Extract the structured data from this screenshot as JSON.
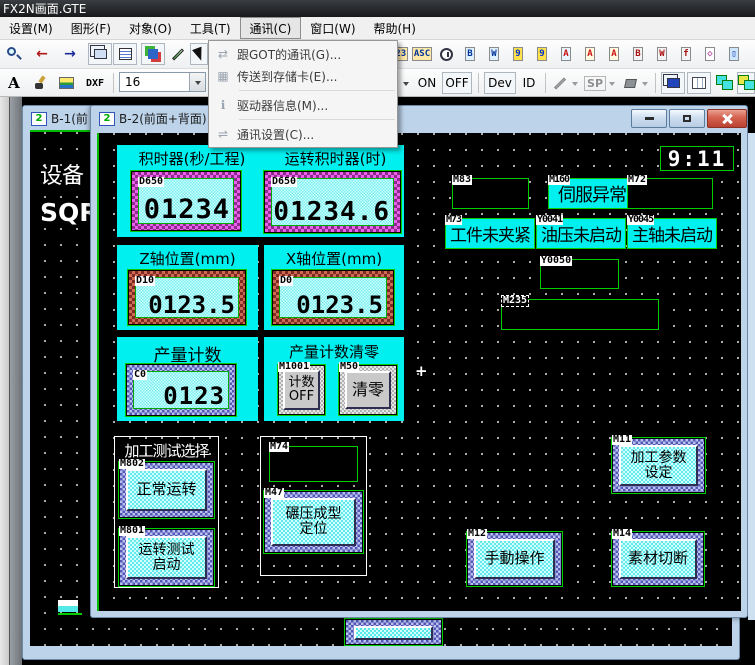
{
  "titlebar": {
    "title": "FX2N画面.GTE"
  },
  "menubar": {
    "items": [
      {
        "label": "设置(M)"
      },
      {
        "label": "图形(F)"
      },
      {
        "label": "对象(O)"
      },
      {
        "label": "工具(T)"
      },
      {
        "label": "通讯(C)"
      },
      {
        "label": "窗口(W)"
      },
      {
        "label": "帮助(H)"
      }
    ]
  },
  "comm_menu": {
    "items": [
      {
        "glyph": "⇄",
        "label": "跟GOT的通讯(G)..."
      },
      {
        "glyph": "▦",
        "label": "传送到存储卡(E)..."
      },
      {
        "glyph": "ℹ",
        "label": "驱动器信息(M)..."
      },
      {
        "glyph": "⇌",
        "label": "通讯设置(C)..."
      }
    ]
  },
  "toolbar1": {
    "objects": [
      {
        "glyph": "123"
      },
      {
        "glyph": "ASC"
      },
      {
        "glyph": "◷"
      },
      {
        "glyph": "B"
      },
      {
        "glyph": "W"
      },
      {
        "glyph": "9"
      },
      {
        "glyph": "9"
      },
      {
        "glyph": "A"
      },
      {
        "glyph": "A"
      },
      {
        "glyph": "A"
      },
      {
        "glyph": "B"
      },
      {
        "glyph": "W"
      },
      {
        "glyph": "f"
      },
      {
        "glyph": "◇"
      },
      {
        "glyph": "▯"
      }
    ]
  },
  "toolbar2": {
    "text_tool": "A",
    "dxf": "DXF",
    "font_size": "16",
    "on": "ON",
    "off": "OFF",
    "dev": "Dev",
    "id": "ID",
    "sp": "SP"
  },
  "windows": {
    "b1_title": "B-1(前",
    "b2_title": "B-2(前面+背面):3",
    "gtd_icon": "2"
  },
  "b1_canvas": {
    "line1": "设备",
    "line2": "SQR"
  },
  "canvas": {
    "clock": "9:11",
    "timer_panel": {
      "header_left": "积时器(秒/工程)",
      "header_right": "运转积时器(时)",
      "display1": {
        "tag": "D650",
        "value": "01234"
      },
      "display2": {
        "tag": "D650",
        "value": "01234.6"
      }
    },
    "z_panel": {
      "header": "Z轴位置(mm)",
      "display": {
        "tag": "D10",
        "value": "0123.5"
      }
    },
    "x_panel": {
      "header": "X轴位置(mm)",
      "display": {
        "tag": "D0",
        "value": "0123.5"
      }
    },
    "count_panel": {
      "header": "产量计数",
      "display": {
        "tag": "C0",
        "value": "0123"
      }
    },
    "clear_panel": {
      "header": "产量计数清零",
      "count_off_btn": {
        "tag": "M1001",
        "line1": "计数",
        "line2": "OFF"
      },
      "clear_btn": {
        "tag": "M50",
        "label": "清零"
      }
    },
    "alarms": {
      "m83": {
        "tag": "M83"
      },
      "m160": {
        "tag": "M160",
        "text": "伺服异常"
      },
      "m72": {
        "tag": "M72"
      },
      "m73": {
        "tag": "M73",
        "text": "工件未夹紧"
      },
      "y0041": {
        "tag": "Y0041",
        "text": "油压未启动"
      },
      "y0045": {
        "tag": "Y0045",
        "text": "主轴未启动"
      },
      "y0050": {
        "tag": "Y0050"
      },
      "m235": {
        "tag": "M235"
      }
    },
    "test_group": {
      "title": "加工测试选择",
      "normal_btn": {
        "tag": "M802",
        "label": "正常运转"
      },
      "test_btn": {
        "tag": "M801",
        "line1": "运转测试",
        "line2": "启动"
      }
    },
    "m74_group": {
      "tag": "M74",
      "forming_btn": {
        "tag": "M47",
        "line1": "碾压成型",
        "line2": "定位"
      }
    },
    "param_btn": {
      "tag": "M11",
      "line1": "加工参数",
      "line2": "设定"
    },
    "manual_btn": {
      "tag": "M12",
      "label": "手動操作"
    },
    "cut_btn": {
      "tag": "M14",
      "label": "素材切断"
    },
    "crosshair": "+"
  },
  "colors": {
    "cyan": "#00f0f0",
    "selection_green": "#00cc00",
    "magenta_border": "#ee5fee",
    "close_red": "#d4614f",
    "frame_blue": "#bdd3ea"
  }
}
